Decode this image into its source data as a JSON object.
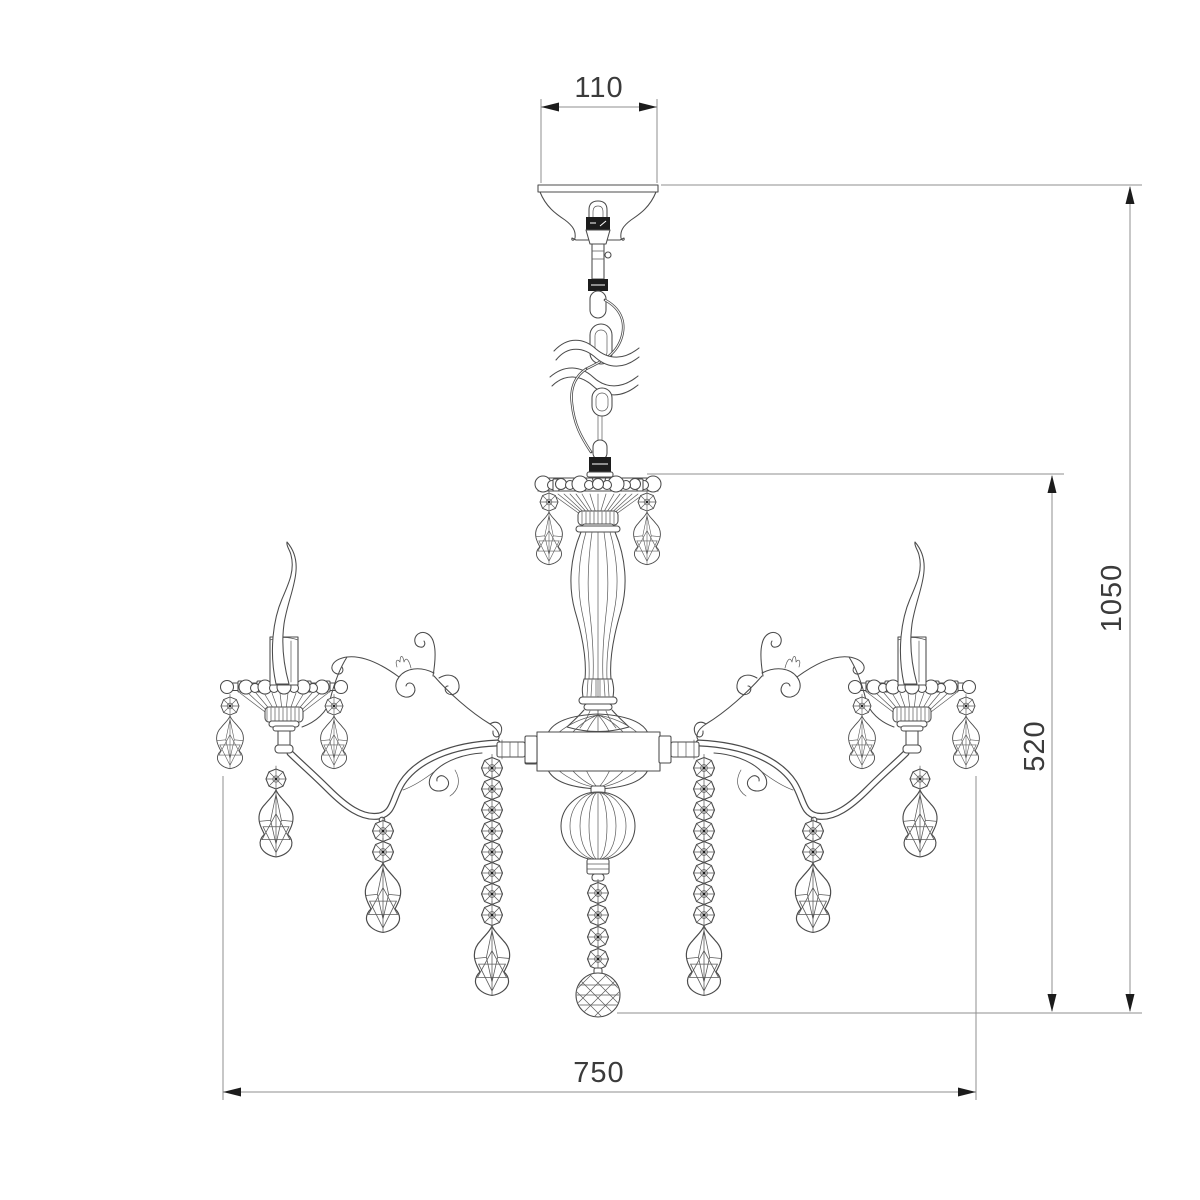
{
  "drawing": {
    "title": "chandelier-dimension-drawing",
    "style": "line-art technical sketch, crystal chandelier front view"
  },
  "dimensions": {
    "canopy_width": "110",
    "overall_height": "1050",
    "body_height": "520",
    "overall_width": "750"
  }
}
